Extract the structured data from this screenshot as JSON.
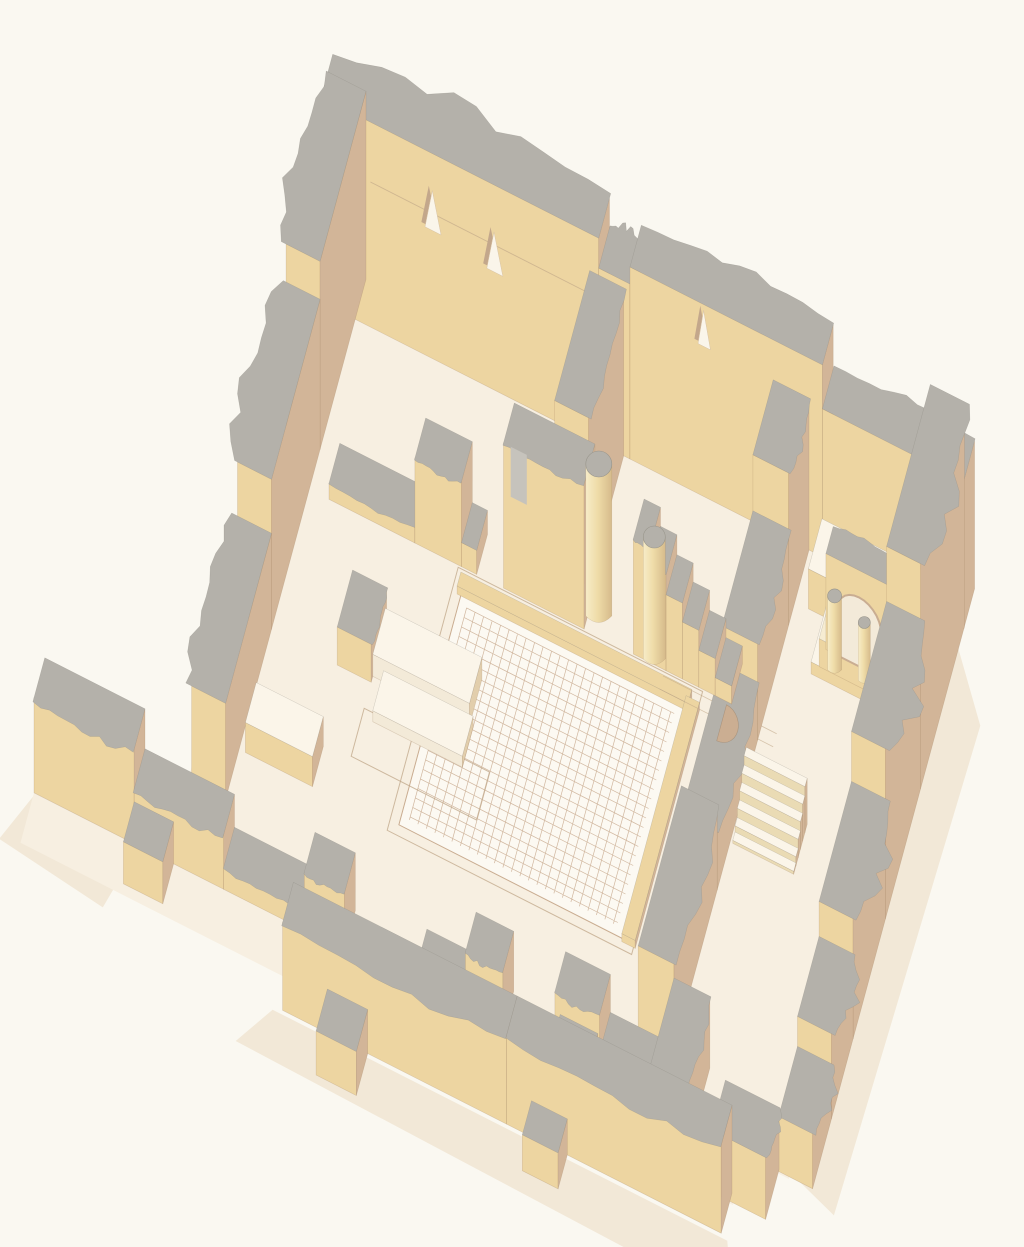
{
  "canvas": {
    "width": 1024,
    "height": 1247,
    "background": "#FAF8F1"
  },
  "palette": {
    "bg": "#FAF8F1",
    "floor": "#F7EFE1",
    "floorPale": "#FBF5E9",
    "top": "#B4B1AA",
    "faceSW": "#EDD5A1",
    "faceSE": "#D2B598",
    "faceSEdark": "#C8A98C",
    "white": "#FCF9F2",
    "mosaicLine": "#C9AC90",
    "shadow": "#F2E8D7",
    "lineBrown": "#BFA687",
    "nicheFill": "#FAF5EA",
    "nicheShade": "#C3A78B",
    "archInner": "#F3EAD9",
    "archRim": "#C9AD92",
    "slotGray": "#C6C3BC",
    "colTop": "#B4B1AA",
    "colLight": "#F7ECC8",
    "colMid": "#EFDCA8",
    "colDark": "#D6BB8B",
    "stepFace": "#EADBB4"
  },
  "projection": {
    "origin": [
      332,
      262
    ],
    "axisU": [
      0.895,
      0.455
    ],
    "axisV": [
      -0.27,
      1.0
    ]
  },
  "elements": [
    {
      "name": "shadow-east-wall",
      "type": "shadowPoly",
      "pts": [
        [
          718,
          60
        ],
        [
          760,
          118
        ],
        [
          746,
          614
        ],
        [
          704,
          600
        ]
      ]
    },
    {
      "name": "shadow-south-wall",
      "type": "shadowPoly",
      "pts": [
        [
          140,
          684
        ],
        [
          648,
          684
        ],
        [
          670,
          738
        ],
        [
          112,
          728
        ]
      ]
    },
    {
      "name": "shadow-southwest-wall",
      "type": "shadowPoly",
      "pts": [
        [
          -152,
          604
        ],
        [
          -36,
          604
        ],
        [
          -54,
          670
        ],
        [
          -174,
          656
        ]
      ]
    },
    {
      "name": "shadow-west-wall-end",
      "type": "shadowPoly",
      "pts": [
        [
          -10,
          520
        ],
        [
          38,
          524
        ],
        [
          28,
          606
        ],
        [
          -20,
          598
        ]
      ]
    },
    {
      "name": "floor-main-hall",
      "type": "floorPoly",
      "pts": [
        [
          28,
          32
        ],
        [
          692,
          32
        ],
        [
          692,
          602
        ],
        [
          28,
          602
        ]
      ]
    },
    {
      "name": "floor-west-strip",
      "type": "floorPoly",
      "pts": [
        [
          -4,
          504
        ],
        [
          28,
          504
        ],
        [
          28,
          602
        ],
        [
          -4,
          602
        ]
      ]
    },
    {
      "name": "floor-forecourt",
      "type": "floorPoly",
      "pts": [
        [
          -152,
          598
        ],
        [
          644,
          598
        ],
        [
          644,
          650
        ],
        [
          -152,
          650
        ]
      ]
    },
    {
      "name": "mosaic-walkway-outline",
      "type": "outlineRect",
      "u0": 205,
      "v0": 212,
      "u1": 478,
      "v1": 475
    },
    {
      "name": "mosaic-floor",
      "type": "mosaic",
      "u0": 215,
      "v0": 235,
      "u1": 465,
      "v1": 465,
      "cell": 9.5,
      "margin": 9
    },
    {
      "name": "mosaic-border-north",
      "type": "wall",
      "u0": 211,
      "v0": 222,
      "u1": 469,
      "v1": 236,
      "h": 8,
      "top": "#EDD5A1"
    },
    {
      "name": "mosaic-border-east",
      "type": "wall",
      "u0": 465,
      "v0": 230,
      "u1": 480,
      "v1": 468,
      "h": 8,
      "top": "#EDD5A1"
    },
    {
      "name": "floor-feature-outline",
      "type": "outlineRect",
      "u0": 150,
      "v0": 378,
      "u1": 290,
      "v1": 426
    },
    {
      "name": "floor-line-1",
      "type": "groundLine",
      "pts": [
        [
          435,
          216
        ],
        [
          562,
          216
        ]
      ]
    },
    {
      "name": "floor-line-2",
      "type": "groundLine",
      "pts": [
        [
          435,
          229
        ],
        [
          562,
          229
        ]
      ]
    },
    {
      "name": "north-wall-west",
      "type": "wall",
      "u0": 0,
      "v0": 0,
      "u1": 310,
      "v1": 40,
      "h": 205,
      "jag": "v0",
      "amp": 26,
      "seed": 3
    },
    {
      "name": "north-wall-mid",
      "type": "wall",
      "u0": 310,
      "v0": 0,
      "u1": 345,
      "v1": 40,
      "h": 175,
      "jag": "v0",
      "amp": 14,
      "seed": 5
    },
    {
      "name": "north-wall-east",
      "type": "wall",
      "u0": 345,
      "v0": 0,
      "u1": 560,
      "v1": 40,
      "h": 192,
      "jag": "v0",
      "amp": 13,
      "seed": 7
    },
    {
      "name": "north-wall-far-east",
      "type": "wall",
      "u0": 560,
      "v0": 0,
      "u1": 718,
      "v1": 40,
      "h": 148,
      "jag": "v0",
      "amp": 11,
      "seed": 9
    },
    {
      "name": "north-wall-seam-line",
      "type": "faceLine",
      "u0": 55,
      "u1": 300,
      "v": 40,
      "z": 145
    },
    {
      "name": "north-wall-niche-1",
      "type": "niche",
      "u": 125,
      "v": 40,
      "zb": 128,
      "zt": 168,
      "w": 9
    },
    {
      "name": "north-wall-niche-2",
      "type": "niche",
      "u": 194,
      "v": 40,
      "zb": 118,
      "zt": 158,
      "w": 9
    },
    {
      "name": "north-wall-niche-3",
      "type": "niche",
      "u": 428,
      "v": 40,
      "zb": 150,
      "zt": 186,
      "w": 7
    },
    {
      "name": "west-wall-north",
      "type": "wall",
      "u0": 0,
      "v0": 0,
      "u1": 38,
      "v1": 170,
      "h": 188,
      "jag": "u0",
      "amp": 24,
      "seed": 11
    },
    {
      "name": "west-wall-mid",
      "type": "wall",
      "u0": 0,
      "v0": 170,
      "u1": 38,
      "v1": 350,
      "h": 150,
      "jag": "u0",
      "amp": 28,
      "seed": 13
    },
    {
      "name": "west-wall-south",
      "type": "wall",
      "u0": 0,
      "v0": 350,
      "u1": 38,
      "v1": 520,
      "h": 96,
      "jag": "u0",
      "amp": 22,
      "seed": 15
    },
    {
      "name": "divider-wall",
      "type": "wall",
      "u0": 300,
      "v0": 40,
      "u1": 338,
      "v1": 170,
      "h": 168,
      "jag": "u1",
      "amp": 9,
      "seed": 17
    },
    {
      "name": "corridor-raised-floor",
      "type": "wall",
      "u0": 560,
      "v0": 42,
      "u1": 700,
      "v1": 92,
      "h": 40,
      "top": "#FBF5E9"
    },
    {
      "name": "aedicula-podium-low",
      "type": "wall",
      "u0": 580,
      "v0": 92,
      "u1": 680,
      "v1": 148,
      "h": 12,
      "top": "#FBF5E9",
      "faceSW": "#EDD5A1"
    },
    {
      "name": "aedicula-podium-high",
      "type": "wall",
      "u0": 586,
      "v0": 94,
      "u1": 672,
      "v1": 138,
      "h": 28,
      "top": "#F6ECD2",
      "faceSW": "#EDD5A1"
    },
    {
      "name": "aedicula-arch-wall",
      "type": "archWall",
      "u0": 588,
      "v0": 94,
      "u1": 668,
      "v1": 120,
      "h": 96,
      "a0": 600,
      "a1": 650,
      "spring": 44,
      "jag": "v0",
      "amp": 6,
      "seed": 19
    },
    {
      "name": "aedicula-column-left",
      "type": "column",
      "u": 602,
      "v": 134,
      "r": 7,
      "h": 74
    },
    {
      "name": "aedicula-column-mid",
      "type": "column",
      "u": 634,
      "v": 130,
      "r": 6,
      "h": 58
    },
    {
      "name": "corridor-west-wall-1",
      "type": "wall",
      "u0": 505,
      "v0": 40,
      "u1": 545,
      "v1": 115,
      "h": 152,
      "jag": "u1",
      "amp": 9,
      "seed": 21
    },
    {
      "name": "corridor-west-wall-2",
      "type": "wall",
      "u0": 505,
      "v0": 115,
      "u1": 545,
      "v1": 230,
      "h": 96,
      "jag": "u1",
      "amp": 11,
      "seed": 23
    },
    {
      "name": "corridor-west-wall-3",
      "type": "wall",
      "u0": 505,
      "v0": 230,
      "u1": 545,
      "v1": 380,
      "h": 58,
      "jag": "u1",
      "amp": 11,
      "seed": 25
    },
    {
      "name": "corridor-west-wall-4",
      "type": "wall",
      "u0": 505,
      "v0": 380,
      "u1": 545,
      "v1": 540,
      "h": 86,
      "jag": "u1",
      "amp": 13,
      "seed": 27
    },
    {
      "name": "court-north-wall-sill",
      "type": "wall",
      "u0": 60,
      "v0": 170,
      "u1": 156,
      "v1": 210,
      "h": 16,
      "jag": "v1",
      "amp": 5,
      "seed": 29
    },
    {
      "name": "court-north-wall-fragment",
      "type": "wall",
      "u0": 156,
      "v0": 170,
      "u1": 208,
      "v1": 210,
      "h": 85,
      "jag": "v1",
      "amp": 7,
      "seed": 31
    },
    {
      "name": "court-north-wall-stub",
      "type": "wall",
      "u0": 208,
      "v0": 170,
      "u1": 225,
      "v1": 210,
      "h": 24
    },
    {
      "name": "court-north-wall-tall",
      "type": "wall",
      "u0": 255,
      "v0": 170,
      "u1": 345,
      "v1": 210,
      "h": 145,
      "jag": "v1",
      "amp": 7,
      "seed": 33
    },
    {
      "name": "court-north-wall-window",
      "type": "faceQuad",
      "u0": 263,
      "u1": 281,
      "v": 210,
      "z0": 95,
      "z1": 145,
      "fill": "#C6C3BC"
    },
    {
      "name": "broken-wall-step-1",
      "type": "wall",
      "u0": 400,
      "v0": 170,
      "u1": 418.3,
      "v1": 210,
      "h": 115,
      "jag": "v1",
      "amp": 4,
      "seed": 35
    },
    {
      "name": "broken-wall-step-2",
      "type": "wall",
      "u0": 418.3,
      "v0": 170,
      "u1": 436.6,
      "v1": 210,
      "h": 96
    },
    {
      "name": "broken-wall-step-3",
      "type": "wall",
      "u0": 436.6,
      "v0": 170,
      "u1": 454.9,
      "v1": 210,
      "h": 76
    },
    {
      "name": "broken-wall-step-4",
      "type": "wall",
      "u0": 454.9,
      "v0": 170,
      "u1": 473.2,
      "v1": 210,
      "h": 57
    },
    {
      "name": "broken-wall-step-5",
      "type": "wall",
      "u0": 473.2,
      "v0": 170,
      "u1": 491.5,
      "v1": 210,
      "h": 37
    },
    {
      "name": "broken-wall-step-6",
      "type": "wall",
      "u0": 491.5,
      "v0": 170,
      "u1": 509.8,
      "v1": 210,
      "h": 18
    },
    {
      "name": "apse-niche",
      "type": "apse",
      "u": 505,
      "v": 231,
      "r": 18
    },
    {
      "name": "column-1",
      "type": "column",
      "u": 356,
      "v": 192,
      "r": 13,
      "h": 152
    },
    {
      "name": "column-2",
      "type": "column",
      "u": 422,
      "v": 205,
      "r": 11,
      "h": 122
    },
    {
      "name": "west-platform-stub",
      "type": "wall",
      "u0": 112,
      "v0": 295,
      "u1": 150,
      "v1": 352,
      "h": 38,
      "jag": "u1",
      "amp": 5,
      "seed": 37
    },
    {
      "name": "west-platform-1",
      "type": "wall",
      "u0": 150,
      "v0": 300,
      "u1": 258,
      "v1": 346,
      "h": 22,
      "top": "#FBF5E9",
      "faceSW": "#F3EAD8",
      "faceSE": "#E2CEAC"
    },
    {
      "name": "west-platform-2",
      "type": "wall",
      "u0": 162,
      "v0": 346,
      "u1": 262,
      "v1": 386,
      "h": 11,
      "top": "#FBF5E9",
      "faceSW": "#F3EAD8",
      "faceSE": "#E2CEAC"
    },
    {
      "name": "stairs",
      "type": "stairs",
      "u0": 548,
      "u1": 616,
      "v0": 282,
      "v1": 332,
      "n": 6,
      "h": 46
    },
    {
      "name": "east-wall-1",
      "type": "wall",
      "u0": 680,
      "v0": 38,
      "u1": 718,
      "v1": 200,
      "h": 225,
      "jag": "u1",
      "amp": 26,
      "seed": 41
    },
    {
      "name": "east-wall-2",
      "type": "wall",
      "u0": 680,
      "v0": 200,
      "u1": 718,
      "v1": 330,
      "h": 170,
      "jag": "u1",
      "amp": 30,
      "seed": 43
    },
    {
      "name": "east-wall-3",
      "type": "wall",
      "u0": 680,
      "v0": 330,
      "u1": 718,
      "v1": 450,
      "h": 120,
      "jag": "u1",
      "amp": 26,
      "seed": 45
    },
    {
      "name": "east-wall-4",
      "type": "wall",
      "u0": 680,
      "v0": 450,
      "u1": 718,
      "v1": 530,
      "h": 85,
      "jag": "u1",
      "amp": 20,
      "seed": 47
    },
    {
      "name": "east-wall-5",
      "type": "wall",
      "u0": 680,
      "v0": 530,
      "u1": 718,
      "v1": 600,
      "h": 55,
      "jag": "u1",
      "amp": 16,
      "seed": 49
    },
    {
      "name": "se-corner-block",
      "type": "wall",
      "u0": 620,
      "v0": 598,
      "u1": 680,
      "v1": 648,
      "h": 62,
      "jag": "u1",
      "amp": 9,
      "seed": 51
    },
    {
      "name": "west-bench",
      "type": "wall",
      "u0": 45,
      "v0": 430,
      "u1": 120,
      "v1": 470,
      "h": 30,
      "top": "#FBF5E9"
    },
    {
      "name": "south-stoa-wall-1",
      "type": "wall",
      "u0": -152,
      "v0": 560,
      "u1": -40,
      "v1": 600,
      "h": 95,
      "jag": "v1",
      "amp": 14,
      "seed": 53
    },
    {
      "name": "south-stoa-wall-2",
      "type": "wall",
      "u0": -40,
      "v0": 560,
      "u1": 60,
      "v1": 600,
      "h": 55,
      "jag": "v1",
      "amp": 12,
      "seed": 55
    },
    {
      "name": "south-stoa-wall-3",
      "type": "wall",
      "u0": 60,
      "v0": 560,
      "u1": 150,
      "v1": 600,
      "h": 22,
      "jag": "v1",
      "amp": 7,
      "seed": 57
    },
    {
      "name": "south-stoa-pier-1",
      "type": "wall",
      "u0": 150,
      "v0": 560,
      "u1": 195,
      "v1": 600,
      "h": 58,
      "jag": "v1",
      "amp": 7,
      "seed": 59
    },
    {
      "name": "south-stoa-wall-4",
      "type": "wall",
      "u0": 275,
      "v0": 560,
      "u1": 330,
      "v1": 600,
      "h": 18,
      "jag": "v1",
      "amp": 5,
      "seed": 61
    },
    {
      "name": "south-stoa-pier-2",
      "type": "wall",
      "u0": 330,
      "v0": 560,
      "u1": 372,
      "v1": 600,
      "h": 60,
      "jag": "v1",
      "amp": 7,
      "seed": 63
    },
    {
      "name": "south-stoa-pier-3",
      "type": "wall",
      "u0": 430,
      "v0": 560,
      "u1": 480,
      "v1": 600,
      "h": 66,
      "jag": "v1",
      "amp": 7,
      "seed": 65
    },
    {
      "name": "south-stoa-wall-5",
      "type": "wall",
      "u0": 480,
      "v0": 560,
      "u1": 545,
      "v1": 600,
      "h": 28,
      "jag": "v1",
      "amp": 7,
      "seed": 67
    },
    {
      "name": "forecourt-pier-1",
      "type": "wall",
      "u0": -40,
      "v0": 600,
      "u1": 4,
      "v1": 640,
      "h": 42
    },
    {
      "name": "forecourt-pier-2",
      "type": "wall",
      "u0": 436,
      "v0": 600,
      "u1": 478,
      "v1": 644,
      "h": 46
    },
    {
      "name": "stub-wall",
      "type": "wall",
      "u0": 545,
      "v0": 540,
      "u1": 585,
      "v1": 640,
      "h": 72,
      "jag": "u1",
      "amp": 9,
      "seed": 69
    },
    {
      "name": "south-wall-west",
      "type": "wall",
      "u0": 150,
      "v0": 640,
      "u1": 400,
      "v1": 680,
      "h": 88,
      "jag": "v1",
      "amp": 13,
      "seed": 71
    },
    {
      "name": "south-wall-east",
      "type": "wall",
      "u0": 400,
      "v0": 640,
      "u1": 640,
      "v1": 680,
      "h": 88,
      "jag": "v1",
      "amp": 13,
      "seed": 73
    },
    {
      "name": "annex-pier-1",
      "type": "wall",
      "u0": 200,
      "v0": 680,
      "u1": 245,
      "v1": 722,
      "h": 44
    },
    {
      "name": "annex-pier-2",
      "type": "wall",
      "u0": 428,
      "v0": 680,
      "u1": 468,
      "v1": 714,
      "h": 36
    }
  ]
}
